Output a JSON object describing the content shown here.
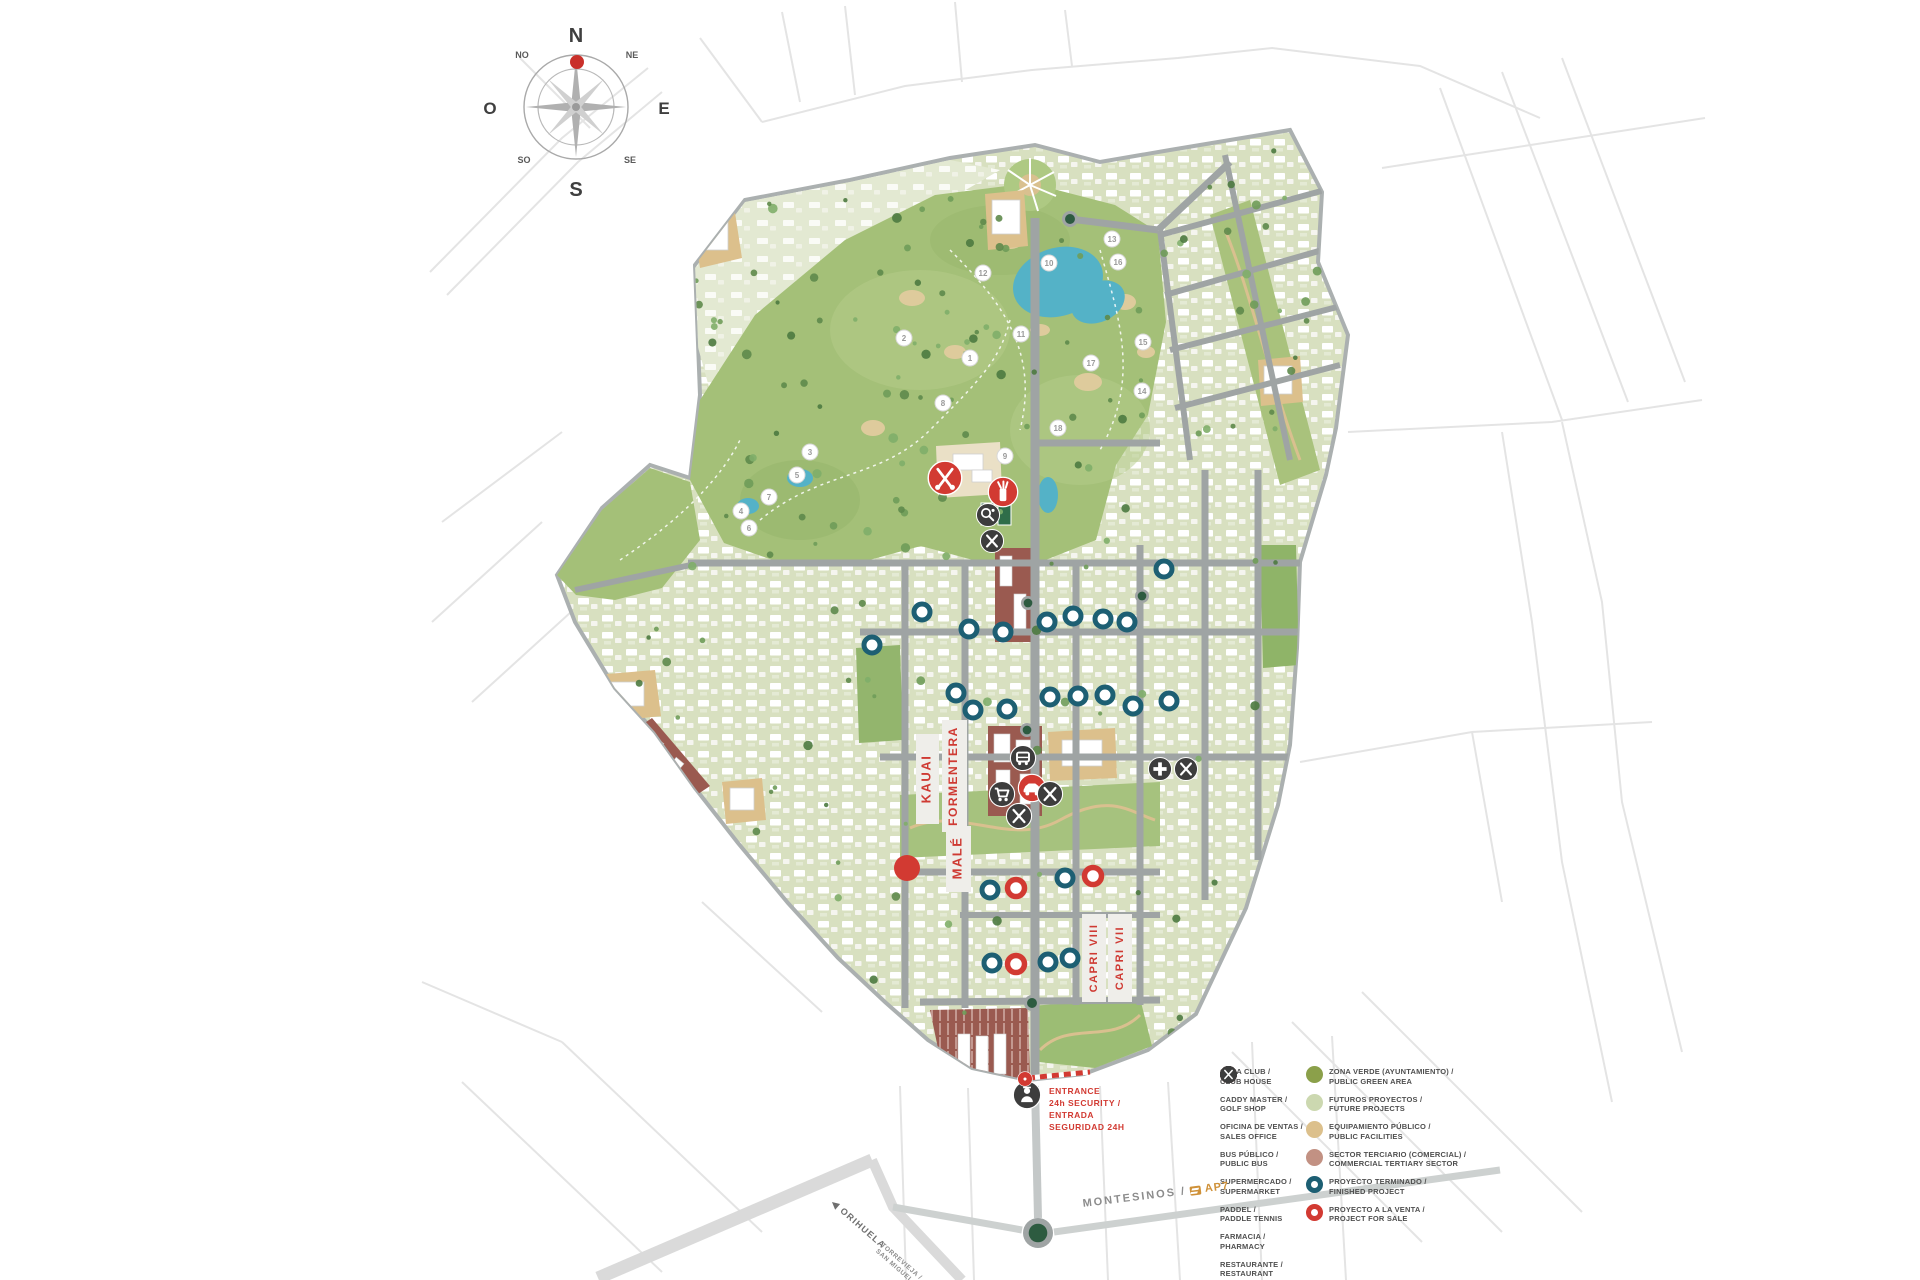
{
  "title": "Resort master plan map",
  "colors": {
    "red": "#d23a32",
    "dark": "#3d3d3d",
    "teal": "#1d5f73",
    "green_public": "#8ba04a",
    "green_future": "#ccd8b0",
    "tan_public": "#dcc08c",
    "mauve_commercial": "#c29183",
    "golf": "#a4c078",
    "road": "#9fa4a4",
    "roundabout": "#2d5b40"
  },
  "compass": {
    "n": "N",
    "ne": "NE",
    "e": "E",
    "se": "SE",
    "s": "S",
    "so": "SO",
    "o": "O",
    "no": "NO"
  },
  "streets": [
    {
      "label": "KAUAI",
      "x": 927,
      "y": 779,
      "strip": [
        916,
        734,
        23,
        90
      ],
      "size": 13
    },
    {
      "label": "FORMENTERA",
      "x": 954,
      "y": 776,
      "strip": [
        942,
        720,
        25,
        112
      ],
      "size": 12
    },
    {
      "label": "MALÉ",
      "x": 958,
      "y": 858,
      "strip": [
        946,
        826,
        25,
        66
      ],
      "size": 13
    },
    {
      "label": "CAPRI VIII",
      "x": 1094,
      "y": 958,
      "strip": [
        1082,
        914,
        24,
        88
      ],
      "size": 11
    },
    {
      "label": "CAPRI VII",
      "x": 1120,
      "y": 958,
      "strip": [
        1108,
        914,
        24,
        88
      ],
      "size": 11
    }
  ],
  "entrance": {
    "lines": [
      "ENTRANCE",
      "24h SECURITY /",
      "ENTRADA",
      "SEGURIDAD 24H"
    ]
  },
  "road_labels": {
    "montesinos": "MONTESINOS /",
    "ap7": "AP7",
    "orihuela": "◀ ORIHUELA",
    "torrevieja_line1": "TORREVIEJA /",
    "torrevieja_line2": "SAN MIGUEL"
  },
  "legend": {
    "services": [
      {
        "type": "golf-clubs",
        "color": "#d23a32",
        "es": "CASA CLUB /",
        "en": "CLUB HOUSE"
      },
      {
        "type": "golf-bag",
        "color": "#d23a32",
        "es": "CADDY MASTER /",
        "en": "GOLF SHOP"
      },
      {
        "type": "car",
        "color": "#d23a32",
        "es": "OFICINA DE VENTAS /",
        "en": "SALES OFFICE"
      },
      {
        "type": "bus",
        "color": "#3d3d3d",
        "es": "BUS PÚBLICO /",
        "en": "PUBLIC BUS"
      },
      {
        "type": "cart",
        "color": "#3d3d3d",
        "es": "SUPERMERCADO /",
        "en": "SUPERMARKET"
      },
      {
        "type": "paddle",
        "color": "#3d3d3d",
        "es": "PADDEL /",
        "en": "PADDLE TENNIS"
      },
      {
        "type": "cross",
        "color": "#3d3d3d",
        "es": "FARMACIA /",
        "en": "PHARMACY"
      },
      {
        "type": "restaurant",
        "color": "#3d3d3d",
        "es": "RESTAURANTE /",
        "en": "RESTAURANT"
      }
    ],
    "zones": [
      {
        "swatch": "fill",
        "color": "#8ba04a",
        "es": "ZONA VERDE (AYUNTAMIENTO) /",
        "en": "PUBLIC GREEN AREA"
      },
      {
        "swatch": "fill",
        "color": "#ccd8b0",
        "es": "FUTUROS PROYECTOS /",
        "en": "FUTURE PROJECTS"
      },
      {
        "swatch": "fill",
        "color": "#dcc08c",
        "es": "EQUIPAMIENTO PÚBLICO /",
        "en": "PUBLIC FACILITIES"
      },
      {
        "swatch": "fill",
        "color": "#c29183",
        "es": "SECTOR TERCIARIO (COMERCIAL) /",
        "en": "COMMERCIAL TERTIARY SECTOR"
      },
      {
        "swatch": "ring",
        "color": "#1d5f73",
        "es": "PROYECTO TERMINADO /",
        "en": "FINISHED PROJECT"
      },
      {
        "swatch": "ring",
        "color": "#d23a32",
        "es": "PROYECTO A LA VENTA /",
        "en": "PROJECT FOR SALE"
      }
    ]
  },
  "markers": {
    "holes": [
      {
        "n": "1",
        "x": 970,
        "y": 358
      },
      {
        "n": "2",
        "x": 904,
        "y": 338
      },
      {
        "n": "3",
        "x": 810,
        "y": 452
      },
      {
        "n": "4",
        "x": 741,
        "y": 511
      },
      {
        "n": "5",
        "x": 797,
        "y": 475
      },
      {
        "n": "6",
        "x": 749,
        "y": 528
      },
      {
        "n": "7",
        "x": 769,
        "y": 497
      },
      {
        "n": "8",
        "x": 943,
        "y": 403
      },
      {
        "n": "9",
        "x": 1005,
        "y": 456
      },
      {
        "n": "10",
        "x": 1049,
        "y": 263
      },
      {
        "n": "11",
        "x": 1021,
        "y": 334
      },
      {
        "n": "12",
        "x": 983,
        "y": 273
      },
      {
        "n": "13",
        "x": 1112,
        "y": 239
      },
      {
        "n": "14",
        "x": 1142,
        "y": 391
      },
      {
        "n": "15",
        "x": 1143,
        "y": 342
      },
      {
        "n": "16",
        "x": 1118,
        "y": 262
      },
      {
        "n": "17",
        "x": 1091,
        "y": 363
      },
      {
        "n": "18",
        "x": 1058,
        "y": 428
      }
    ],
    "finished": [
      [
        969,
        629
      ],
      [
        1003,
        632
      ],
      [
        1047,
        622
      ],
      [
        1073,
        616
      ],
      [
        1103,
        619
      ],
      [
        1127,
        622
      ],
      [
        1050,
        697
      ],
      [
        1078,
        696
      ],
      [
        1105,
        695
      ],
      [
        973,
        710
      ],
      [
        1007,
        709
      ],
      [
        1133,
        706
      ],
      [
        1065,
        878
      ],
      [
        990,
        890
      ],
      [
        1048,
        962
      ],
      [
        1070,
        958
      ],
      [
        992,
        963
      ],
      [
        1164,
        569
      ],
      [
        1169,
        701
      ],
      [
        872,
        645
      ],
      [
        922,
        612
      ],
      [
        956,
        693
      ]
    ],
    "for_sale": [
      [
        1016,
        888
      ],
      [
        1093,
        876
      ],
      [
        1016,
        964
      ]
    ],
    "red_dot": {
      "x": 907,
      "y": 868
    },
    "amenities": [
      {
        "type": "golf-clubs",
        "x": 945,
        "y": 478,
        "c": "red",
        "r": 16
      },
      {
        "type": "golf-bag",
        "x": 1003,
        "y": 492,
        "c": "red",
        "r": 14
      },
      {
        "type": "paddle",
        "x": 988,
        "y": 515,
        "c": "dark",
        "r": 11
      },
      {
        "type": "restaurant",
        "x": 992,
        "y": 541,
        "c": "dark",
        "r": 11
      },
      {
        "type": "bus",
        "x": 1023,
        "y": 758,
        "c": "dark",
        "r": 12
      },
      {
        "type": "car",
        "x": 1032,
        "y": 788,
        "c": "red",
        "r": 13
      },
      {
        "type": "cart",
        "x": 1002,
        "y": 794,
        "c": "dark",
        "r": 12
      },
      {
        "type": "restaurant",
        "x": 1050,
        "y": 794,
        "c": "dark",
        "r": 12
      },
      {
        "type": "restaurant",
        "x": 1019,
        "y": 816,
        "c": "dark",
        "r": 12
      },
      {
        "type": "cross",
        "x": 1160,
        "y": 769,
        "c": "dark",
        "r": 11
      },
      {
        "type": "restaurant",
        "x": 1186,
        "y": 769,
        "c": "dark",
        "r": 11
      },
      {
        "type": "security-guard",
        "x": 1027,
        "y": 1095,
        "c": "dark",
        "r": 13
      },
      {
        "type": "gate",
        "x": 1025,
        "y": 1079,
        "c": "red",
        "r": 7
      }
    ],
    "roundabouts": [
      {
        "x": 1070,
        "y": 219,
        "r": 8
      },
      {
        "x": 1028,
        "y": 603,
        "r": 7
      },
      {
        "x": 1142,
        "y": 596,
        "r": 7
      },
      {
        "x": 1027,
        "y": 730,
        "r": 7
      },
      {
        "x": 1032,
        "y": 1003,
        "r": 8
      },
      {
        "x": 1038,
        "y": 1233,
        "r": 15
      }
    ]
  }
}
